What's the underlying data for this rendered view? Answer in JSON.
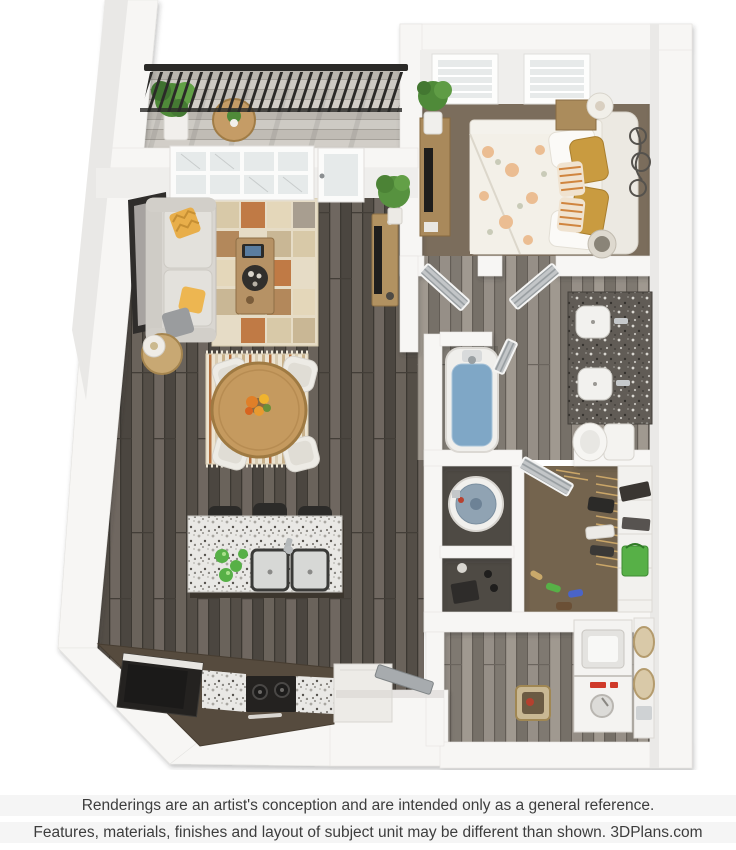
{
  "footer": {
    "line1": "Renderings are an artist's conception and are intended only as a general reference.",
    "line2": "Features, materials, finishes and layout of subject unit may be different than shown. 3DPlans.com"
  },
  "floorplan": {
    "view": "3D top-down rendering of a one-bedroom apartment",
    "rooms": [
      {
        "name": "balcony",
        "items": [
          "black metal railing",
          "potted plant",
          "round bistro table with small plant"
        ]
      },
      {
        "name": "living-room",
        "items": [
          "light gray sofa with yellow and gray pillows",
          "framed wall art",
          "round side table with lamp",
          "patchwork area rug",
          "wood coffee table with tray and tablet",
          "media console with TV",
          "potted tree",
          "large window",
          "glass balcony door"
        ]
      },
      {
        "name": "dining-area",
        "items": [
          "round wood table with flower centerpiece",
          "four white chairs",
          "striped cream rug"
        ]
      },
      {
        "name": "kitchen",
        "items": [
          "granite island with double sink and faucet",
          "green glassware",
          "three black bar stools",
          "black refrigerator",
          "black cooktop",
          "granite counters",
          "white cabinet"
        ]
      },
      {
        "name": "bedroom",
        "items": [
          "two windows with blinds",
          "bed with floral comforter",
          "mustard and striped accent pillows",
          "upholstered headboard",
          "nightstand with lamp",
          "dresser with TV",
          "potted plant",
          "metal scroll wall decor",
          "round hamper"
        ]
      },
      {
        "name": "bathroom",
        "items": [
          "bathtub filled with water",
          "granite double-sink vanity",
          "toilet",
          "louvered doors"
        ]
      },
      {
        "name": "walk-in-closet",
        "items": [
          "hanging clothes on rod",
          "white shelving",
          "storage boxes",
          "green tote bag",
          "shoes"
        ]
      },
      {
        "name": "utility-closet",
        "items": [
          "water heater"
        ]
      },
      {
        "name": "linen-closet",
        "items": [
          "shoe boxes",
          "shoes"
        ]
      },
      {
        "name": "laundry-room",
        "items": [
          "stacked washer and dryer",
          "wicker baskets on door shelf",
          "woven floor basket"
        ]
      },
      {
        "name": "entry",
        "items": [
          "open metal front door",
          "white cabinet"
        ]
      }
    ],
    "colors": {
      "wall_white": "#f7f6f4",
      "wall_face": "#efeeec",
      "plank_dark": "#5f5851",
      "plank_light": "#8b857d",
      "balcony_floor": "#c9c5bf",
      "bedroom_carpet": "#7b6d5c",
      "closet_carpet": "#74644e",
      "dark_floor": "#4e4a44",
      "water_blue": "#7fa7c6",
      "sofa_gray": "#d9d6d1",
      "accent_yellow": "#e8ae4a",
      "accent_rust": "#c07a45",
      "rug_cream": "#e6dcc6",
      "wood_furniture": "#c59a5f",
      "cabinet_brown": "#564b3e",
      "appliance_black": "#242220",
      "granite_light": "#e9e8e5",
      "granite_dark": "#615c56",
      "accent_green": "#57b047",
      "laundry_red": "#cf3a2a",
      "railing_black": "#2b2a28",
      "door_gray": "#a7abae",
      "footer_text": "#3d3d3d"
    }
  }
}
